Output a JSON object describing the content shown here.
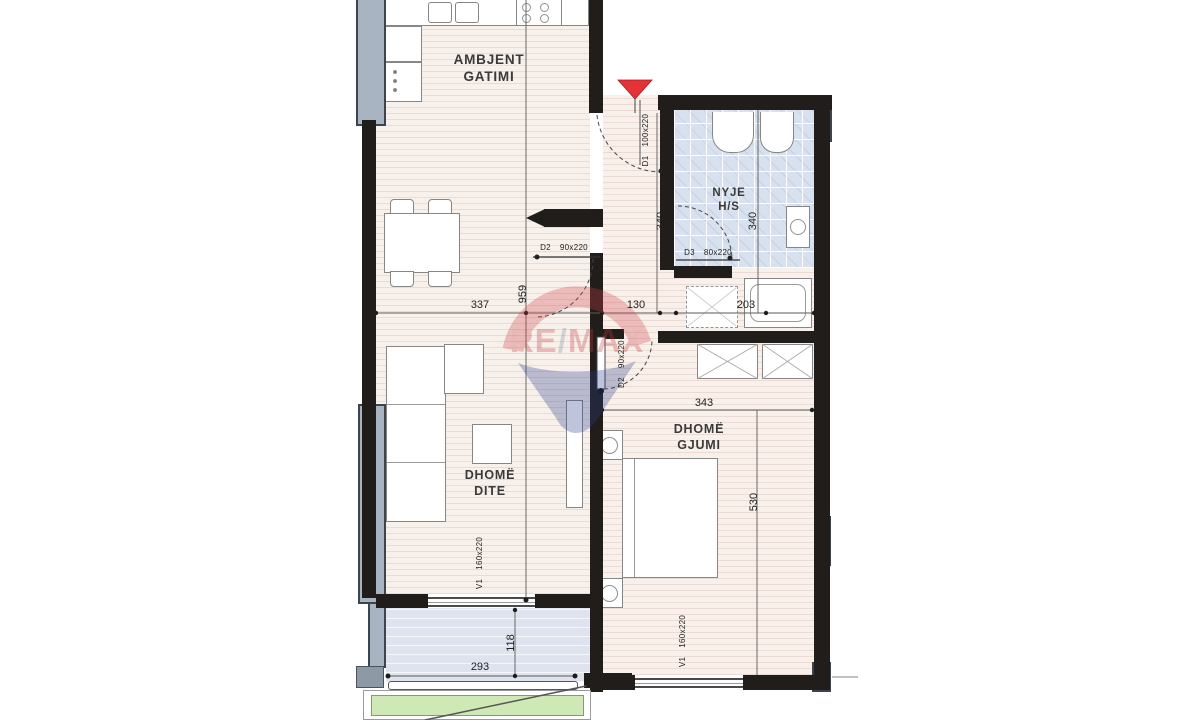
{
  "watermark": {
    "part_re": "RE",
    "part_slash": "/",
    "part_max": "MAX"
  },
  "rooms": {
    "kitchen": {
      "line1": "AMBJENT",
      "line2": "GATIMI"
    },
    "bathroom": {
      "line1": "NYJE",
      "line2": "H/S"
    },
    "living": {
      "line1": "DHOMË",
      "line2": "DITE"
    },
    "bedroom": {
      "line1": "DHOMË",
      "line2": "GJUMI"
    }
  },
  "dimensions": {
    "living_zone_width": "337",
    "vertical_total": "959",
    "hall_width": "130",
    "hall_pocket_width": "203",
    "hall_height": "340",
    "bathroom_height": "340",
    "bedroom_width": "343",
    "bedroom_height": "530",
    "balcony_width": "293",
    "balcony_depth": "118"
  },
  "openings": {
    "d1": {
      "id": "D1",
      "size": "100x220"
    },
    "d2_living": {
      "id": "D2",
      "size": "90x220"
    },
    "d3_bath": {
      "id": "D3",
      "size": "80x220"
    },
    "d2_bedroom": {
      "id": "D2",
      "size": "90x220"
    },
    "v1_living": {
      "id": "V1",
      "size": "160x220"
    },
    "v1_bedroom": {
      "id": "V1",
      "size": "160x220"
    }
  },
  "colors": {
    "wall": "#201d1a",
    "floor": "#f8f1eb",
    "bath_tile": "#d7e1ef",
    "balcony": "#dee3ed",
    "terrace_green": "#cfe9b6",
    "window_panel": "#a9b4c2",
    "entrance_marker": "#e63137",
    "watermark_red": "#c5373e",
    "watermark_blue": "#2b3f8c"
  }
}
